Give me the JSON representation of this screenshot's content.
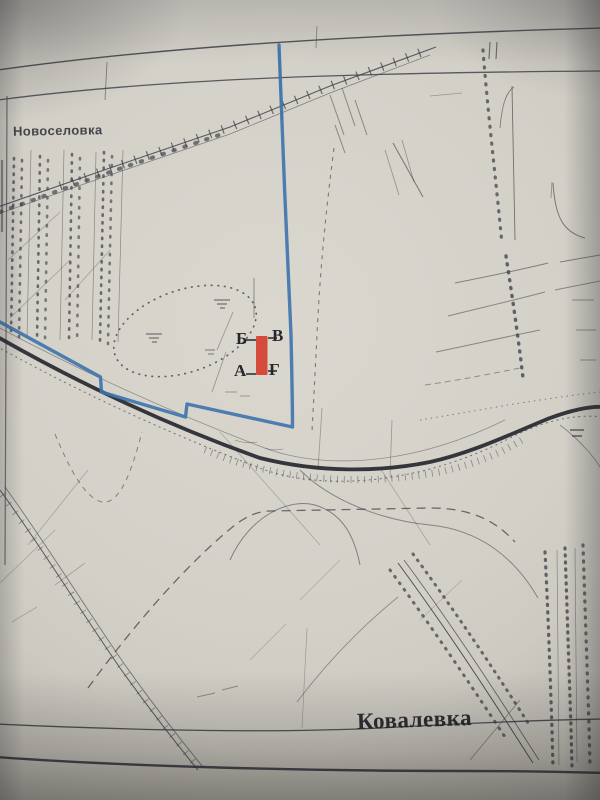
{
  "map": {
    "settlement_top_label": "Новоселовка",
    "settlement_bottom_label": "Ковалевка",
    "profile_marker": {
      "top_left": "Б",
      "top_right": "В",
      "bottom_left": "А",
      "bottom_right": "Г"
    },
    "colors": {
      "route_blue": "#3e74ad",
      "marker_red": "#d64233",
      "ink": "#3b3b44"
    }
  }
}
